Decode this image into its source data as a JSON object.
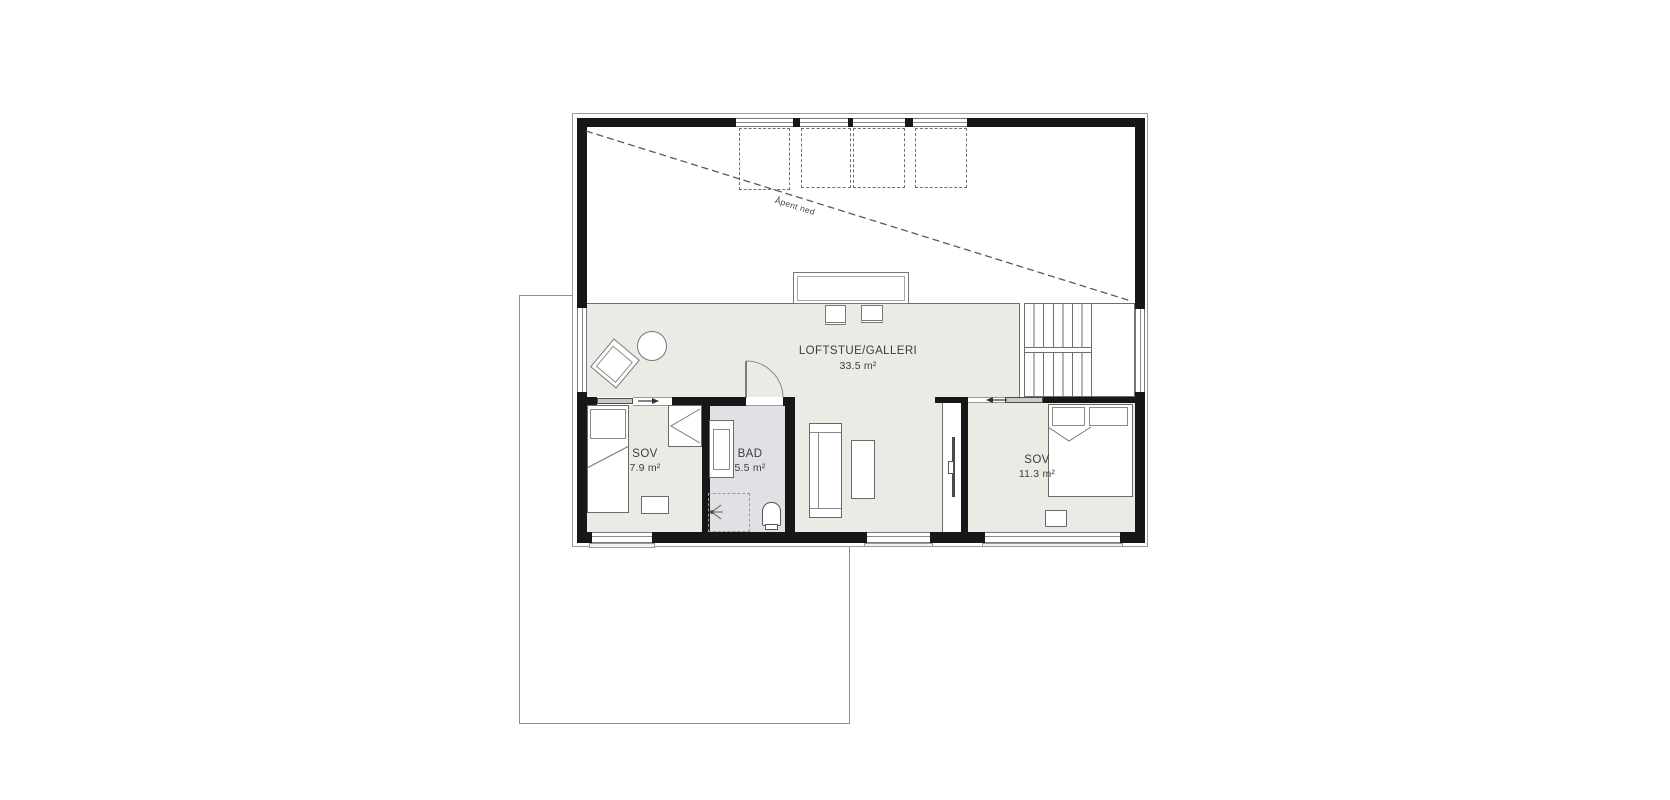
{
  "annotations": {
    "open_below": "Åpent ned"
  },
  "rooms": [
    {
      "id": "loftstue",
      "name": "LOFTSTUE/GALLERI",
      "area": "33.5 m²"
    },
    {
      "id": "sov-left",
      "name": "SOV",
      "area": "7.9 m²"
    },
    {
      "id": "bad",
      "name": "BAD",
      "area": "5.5 m²"
    },
    {
      "id": "sov-right",
      "name": "SOV",
      "area": "11.3 m²"
    }
  ],
  "colors": {
    "wall": "#171717",
    "floor": "#eceae4",
    "bath_floor": "#e1e1e5",
    "line": "#6e6e6e"
  }
}
